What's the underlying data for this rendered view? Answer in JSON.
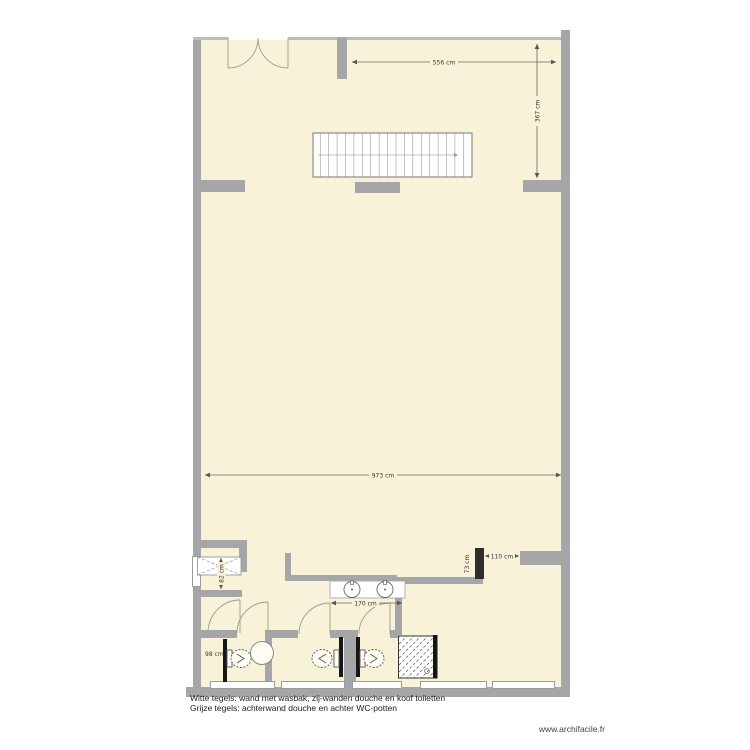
{
  "watermark": {
    "label": "www.archifacile.fr"
  },
  "legend": {
    "line1": "Witte tegels: wand met wasbak, zij-wanden douche en koof toiletten",
    "line2": "Grijze tegels: achterwand douche en achter WC-potten"
  },
  "dimensions": {
    "upper_room_width": "556 cm",
    "upper_room_height": "367 cm",
    "main_room_width": "973 cm",
    "washbasin_counter_width": "170 cm",
    "passage_width": "110 cm",
    "shower_back_wall": "73 cm",
    "closet_depth": "82 cm",
    "toilet_room_width": "98 cm"
  },
  "symbols": {
    "staircase": "staircase with direction arrow",
    "entrance": "double swing door",
    "wc": "toilet",
    "washbasin": "round washbasin",
    "counter": "counter with two washbasins",
    "shower": "hatched shower tray",
    "cupboard": "dashed-cross cupboard"
  },
  "colors": {
    "floor": "#f8f3d8",
    "wall": "#a6a6a8",
    "tile_black": "#161616",
    "background": "#ffffff"
  }
}
